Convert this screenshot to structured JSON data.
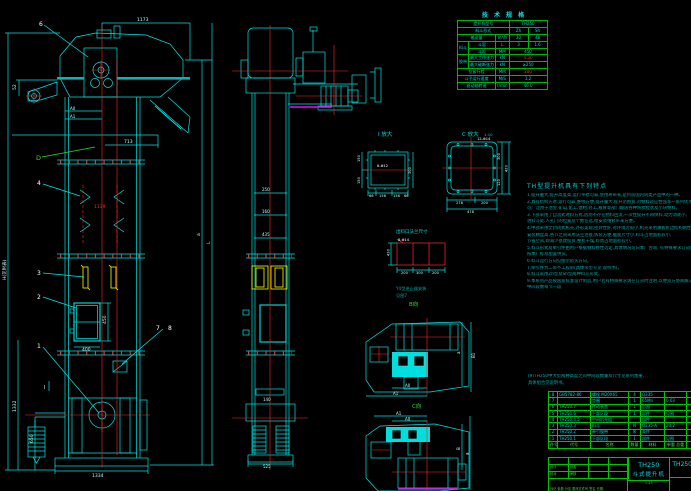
{
  "labels": {
    "leader_6": "6",
    "leader_4": "4",
    "leader_3": "3",
    "leader_2": "2",
    "leader_1": "1",
    "leader_7": "7",
    "leader_8": "8",
    "section_d": "D",
    "section_i": "I",
    "view_b": "B向",
    "view_c_dir": "C向",
    "h_total": "H(见附表)",
    "view_i": "I 放大",
    "view_c": "C 放大",
    "view_c_scale": "1:10",
    "inlet_title": "出料口法兰尺寸",
    "bolt_i": "8-Φ12",
    "bolt_c": "12-Φ14",
    "bolt_inlet": "8-Φ14",
    "note_y4a": "Y4型逆止器安装",
    "note_y4b": "见图7",
    "pa0": "A0",
    "pa1": "A1",
    "pb": "B",
    "pb1": "B1",
    "pa": "a",
    "pl": "L"
  },
  "dims": {
    "top_width": "1173",
    "arm_h": "52",
    "mid_width": "713",
    "bucket_pitch": "1139",
    "door_h": "450",
    "door_w": "400",
    "left_h1": "1332",
    "left_h2": "650",
    "base_w": "1334",
    "side_b1": "250",
    "side_b2": "160",
    "side_b3": "435",
    "side_takeup": "140",
    "side_base": "525",
    "i_left1": "150",
    "i_left2": "150",
    "i_right": "300",
    "i_b1": "66",
    "i_b2": "156",
    "i_b3": "156",
    "i_b4": "66",
    "c_r1": "300",
    "c_r2": "120",
    "c_r3": "420",
    "c_b1": "278",
    "c_b2": "200",
    "c_b3": "478",
    "in_left": "430",
    "in_b1": "200",
    "in_b2": "300",
    "in_b3": "200"
  },
  "spec": {
    "title": "技 术 规 格",
    "r1l": "提升机型号",
    "r1v": "TH250",
    "r2l": "料斗形式",
    "r2a": "Zh",
    "r2b": "Sh",
    "r3l": "输送量",
    "r3u": "m³/h",
    "r3a": "30",
    "r3b": "48",
    "g1": "料斗",
    "r4l": "斗容",
    "r4u": "L",
    "r4a": "3",
    "r4b": "1.6",
    "r5l": "斗距",
    "r5u": "MM",
    "r5v": "450",
    "g2": "胶带",
    "r6l": "最大工作张力",
    "r6u": "kN",
    "r6v": "4.30",
    "r7l": "最大破断张力",
    "r7u": "kN",
    "r7v": "≥250",
    "r8l": "拉紧行程",
    "r8u": "MM",
    "r8v": "200",
    "r9l": "斗子运行速度",
    "r9u": "M/S",
    "r9v": "1.2",
    "r10l": "驱动轴转速",
    "r10u": "r/min",
    "r10v": "46.0"
  },
  "notes": {
    "title": "TH型提升机具有下列特点",
    "lines": [
      "1.提升量大,提升高度高,运行平稳可靠,使用寿命长,是目前国内同类产品中的一种。",
      "2.具有结构先进,运行可靠,维修方便,提升量大,提升范围宽,对物料适应性强等一系列优点,",
      "  可广泛用于冶金,矿山,化工,建材,轻工,粮食等部门输送各种粉状粒状及小块物料。",
      "3.下部采用了自流式进料方式,因而不存在物料回流,一次性提升不再倒料,动力消耗小,",
      "  进料斗处,人孔门的位置及个数任选,给安装维修带来方便。",
      "4.中部采用全封闭式机壳,外形美观,密封性好,对环境污染小,机壳采用薄板折边结构刚性好,",
      "  安装精度高,各节之间采用法兰连接,拆装方便,截面尺寸小,料斗占地面积较小,",
      "  节省空间,即减少基建投资,整机干燥,料周占地面积较小。",
      "5.料斗形式及牵引件由用户根据物料特性选定,具体情况可向本厂咨询,  有特殊要求订货时须注明,",
      "  按本厂标准配置供货。",
      "6.料斗运行方向见图示箭头方向。",
      "7.牵引件为二带不工胶带(具体带型号见 说明书)。",
      "8.料斗采用Zh型及Sh型两种料斗形式。",
      "9.本系列产品按国家标准设计制造,用户若有特殊要求请在订货时注明,以便双方协商解决供货。",
      "",
      "  中间段数每节一段"
    ],
    "f1": "(9)TH250中大型两种高度之间中间段数量及尺寸见系列图册,",
    "f2": "   具体组合见说明书。"
  },
  "bom": {
    "header": {
      "no": "件号",
      "code": "代号",
      "name": "名称",
      "qty": "数量",
      "mat": "材料",
      "wt": "单重 总重",
      "rem": "备注"
    },
    "rows": [
      {
        "no": "8",
        "code": "GB5782-86",
        "name": "螺栓 M20X65",
        "qty": "4",
        "mat": "Q235",
        "wt": "",
        "rem": ""
      },
      {
        "no": "7",
        "code": "",
        "name": "垫圈",
        "qty": "1",
        "mat": "65Mn",
        "wt": "0.03",
        "rem": ""
      },
      {
        "no": "6",
        "code": "TH250.7",
        "name": "传动装置",
        "qty": "1",
        "mat": "总图",
        "wt": "",
        "rem": ""
      },
      {
        "no": "5",
        "code": "TH250.6",
        "name": "上部区段",
        "qty": "1",
        "mat": "部件",
        "wt": "见图",
        "rem": ""
      },
      {
        "no": "4",
        "code": "TH250.4,5",
        "name": "中间机壳组",
        "qty": "",
        "mat": "部件",
        "wt": "",
        "rem": ""
      },
      {
        "no": "3",
        "code": "TH250.3",
        "name": "料斗",
        "qty": "N",
        "mat": "Q235-A",
        "wt": "20.2",
        "rem": ""
      },
      {
        "no": "2",
        "code": "TH250.2",
        "name": "牵引胶带",
        "qty": "米",
        "mat": "条件",
        "wt": "",
        "rem": ""
      },
      {
        "no": "1",
        "code": "TH250.1",
        "name": "下部区段",
        "qty": "1",
        "mat": "部件",
        "wt": "见图",
        "rem": ""
      }
    ]
  },
  "tb": {
    "model": "TH250",
    "name": "斗式提升机",
    "dwg": "TH250",
    "scale": "1:25",
    "sig": "标记 处数 分区 更改文件号 签名 日期",
    "l0": "设计",
    "l1": "制图",
    "l2": "校对",
    "l3": "审核"
  }
}
